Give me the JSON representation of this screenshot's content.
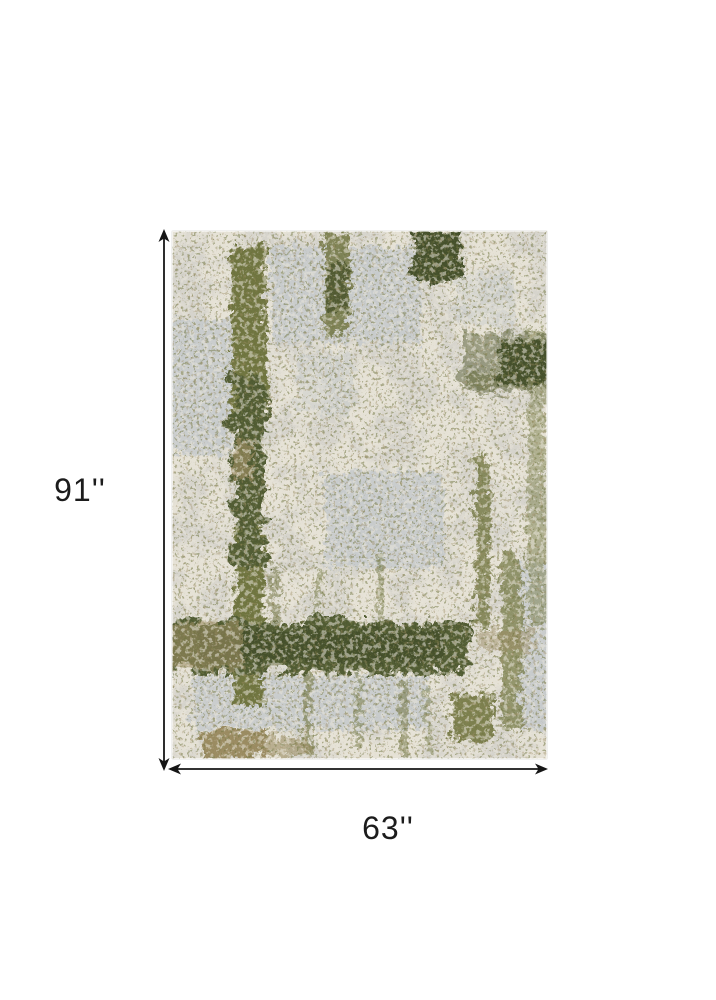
{
  "figure": {
    "type": "product-dimension-diagram",
    "product_name": "Abstract distressed area rug in ivory and olive green",
    "dimensions": {
      "height_label": "91''",
      "width_label": "63''"
    },
    "annotation": {
      "color": "#161616"
    },
    "rug_colors": {
      "base": "#d7d5ce",
      "ivory": "#eae6da",
      "gray_blue": "#c6cbce",
      "olive": "#6b7038",
      "dark_olive": "#4a5429",
      "deep_green": "#3e4a23",
      "tan": "#98885c"
    }
  }
}
